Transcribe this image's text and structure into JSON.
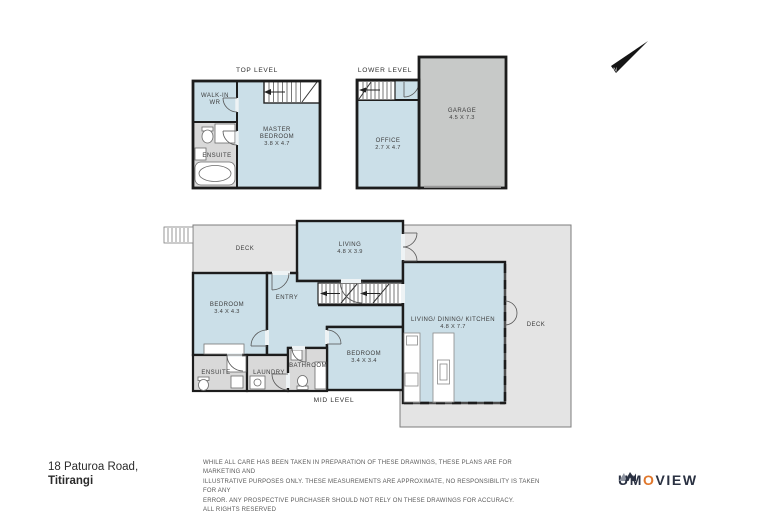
{
  "address": {
    "line1": "18 Paturoa Road,",
    "line2": "Titirangi"
  },
  "disclaimer": {
    "line1": "WHILE ALL CARE HAS BEEN TAKEN IN PREPARATION OF THESE DRAWINGS, THESE PLANS ARE FOR MARKETING AND",
    "line2": "ILLUSTRATIVE PURPOSES ONLY. THESE MEASUREMENTS ARE APPROXIMATE, NO RESPONSIBILITY IS TAKEN FOR ANY",
    "line3": "ERROR. ANY PROSPECTIVE PURCHASER SHOULD NOT RELY ON THESE DRAWINGS FOR ACCURACY.",
    "line4": "ALL RIGHTS RESERVED"
  },
  "logo": {
    "part1": "UM",
    "accent": "O",
    "part2": "VIEW"
  },
  "compass": {
    "label": "N"
  },
  "top_level": {
    "title": "TOP LEVEL",
    "walk_in_line1": "WALK-IN",
    "walk_in_line2": "WR",
    "ensuite": "ENSUITE",
    "master_line1": "MASTER",
    "master_line2": "BEDROOM",
    "master_dims": "3.8 X 4.7"
  },
  "lower_level": {
    "title": "LOWER LEVEL",
    "office": "OFFICE",
    "office_dims": "2.7 X 4.7",
    "garage": "GARAGE",
    "garage_dims": "4.5 X 7.3"
  },
  "mid_level": {
    "title": "MID LEVEL",
    "deck_left": "DECK",
    "living": "LIVING",
    "living_dims": "4.8 X 3.9",
    "bedroom1": "BEDROOM",
    "bedroom1_dims": "3.4 X 4.3",
    "entry": "ENTRY",
    "ensuite": "ENSUITE",
    "laundry": "LAUNDRY",
    "bathroom": "BATHROOM",
    "bedroom2": "BEDROOM",
    "bedroom2_dims": "3.4 X 3.4",
    "ldk": "LIVING/ DINING/ KITCHEN",
    "ldk_dims": "4.8 X 7.7",
    "deck_right": "DECK"
  },
  "colors": {
    "wall": "#1c1c1c",
    "room_blue": "#cbdfe8",
    "wet_room_gray": "#d9d9d9",
    "garage_gray": "#c7c9c8",
    "deck_gray": "#e4e4e4",
    "label_gray": "#3d3d3d",
    "logo_navy": "#2a3142",
    "logo_orange": "#e0762a",
    "compass_black": "#151515"
  }
}
